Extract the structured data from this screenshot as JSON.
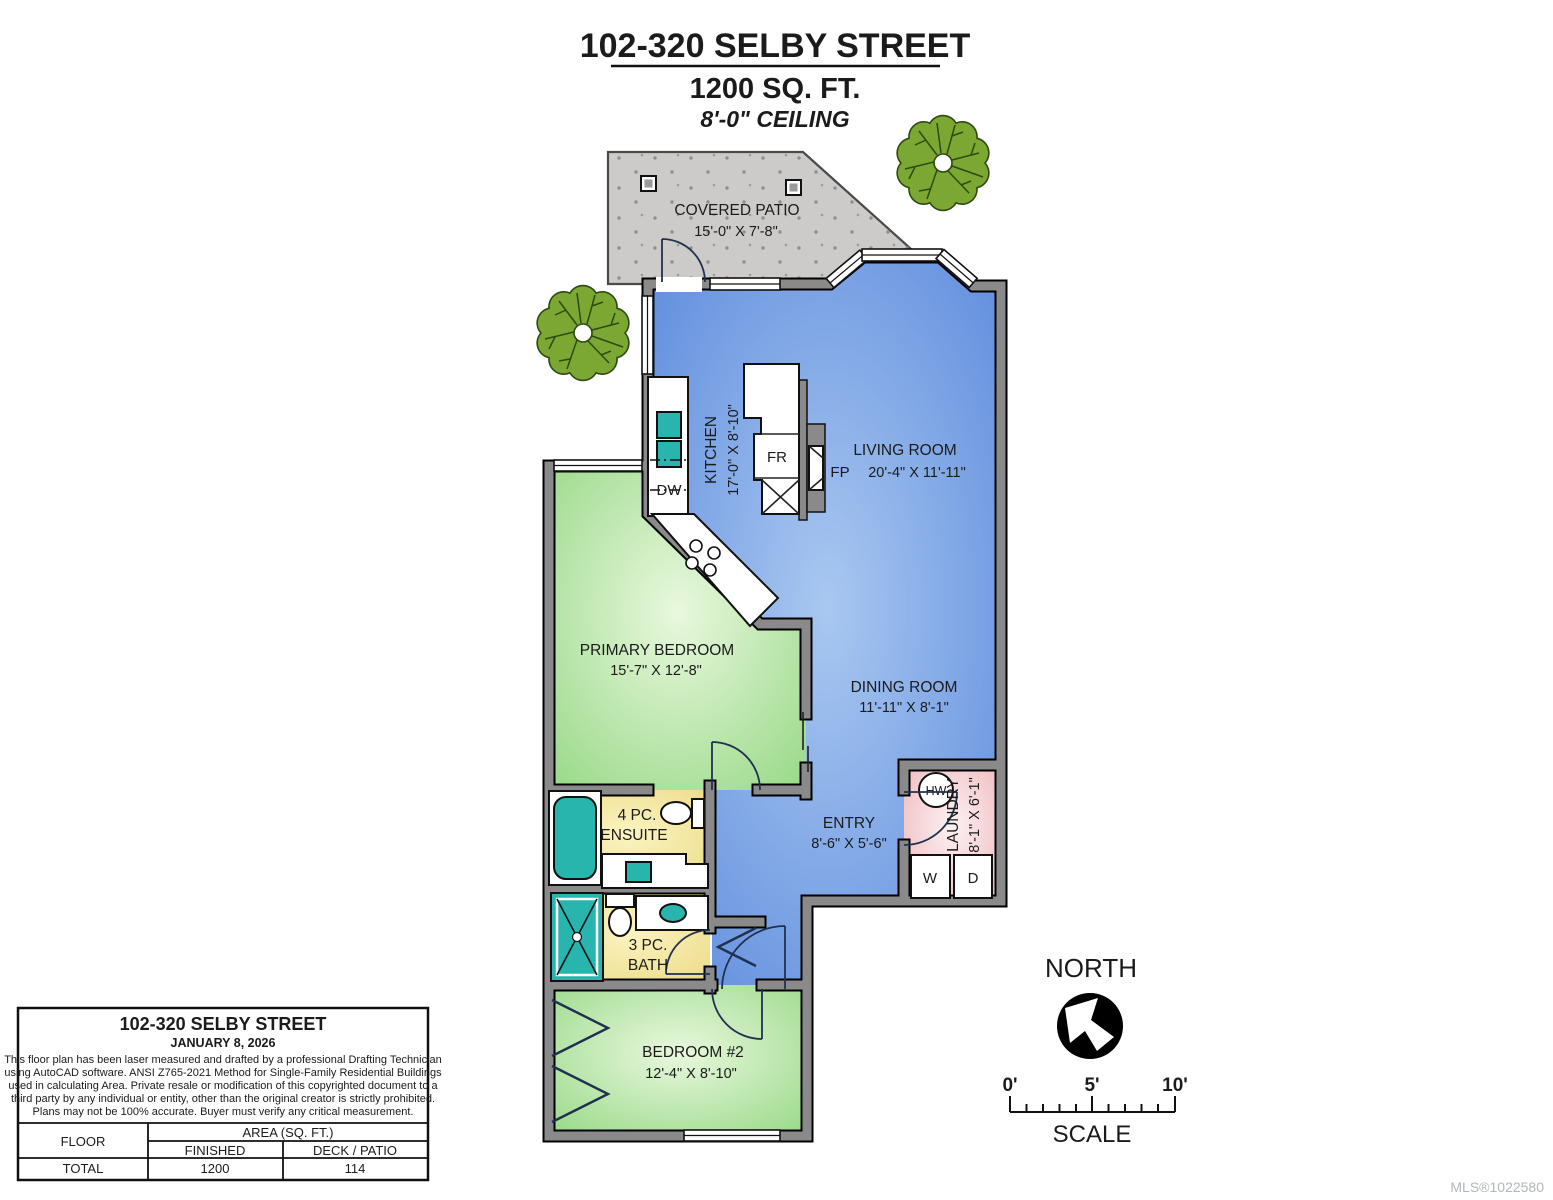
{
  "title": {
    "address": "102-320 SELBY STREET",
    "sqft": "1200 SQ. FT.",
    "ceiling": "8'-0\" CEILING"
  },
  "rooms": {
    "patio": {
      "name": "COVERED PATIO",
      "dims": "15'-0\" X 7'-8\""
    },
    "kitchen": {
      "name": "KITCHEN",
      "dims": "17'-0\" X 8'-10\""
    },
    "living": {
      "name": "LIVING ROOM",
      "dims": "20'-4\" X 11'-11\""
    },
    "dining": {
      "name": "DINING ROOM",
      "dims": "11'-11\" X 8'-1\""
    },
    "primary": {
      "name": "PRIMARY BEDROOM",
      "dims": "15'-7\" X 12'-8\""
    },
    "ensuite": {
      "line1": "4 PC.",
      "line2": "ENSUITE"
    },
    "bath": {
      "line1": "3 PC.",
      "line2": "BATH"
    },
    "entry": {
      "name": "ENTRY",
      "dims": "8'-6\" X 5'-6\""
    },
    "laundry": {
      "name": "LAUNDRY",
      "dims": "8'-1\" X 6'-1\""
    },
    "bedroom2": {
      "name": "BEDROOM #2",
      "dims": "12'-4\" X 8'-10\""
    }
  },
  "labels": {
    "fp": "FP",
    "fr": "FR",
    "dw": "DW",
    "hw": "HW",
    "w": "W",
    "d": "D"
  },
  "compass": {
    "north": "NORTH",
    "scale": "SCALE",
    "tick0": "0'",
    "tick5": "5'",
    "tick10": "10'"
  },
  "infobox": {
    "title": "102-320 SELBY STREET",
    "date": "JANUARY 8, 2026",
    "disclaimer": [
      "This floor plan has been laser measured and drafted by a professional Drafting Technician",
      "using AutoCAD software. ANSI Z765-2021 Method for Single-Family Residential Buildings",
      "used in calculating Area. Private resale or modification of this copyrighted document to a",
      "third party by any individual or entity, other than the original creator is strictly prohibited.",
      "Plans may not be 100% accurate.  Buyer must verify any critical measurement."
    ],
    "table": {
      "floor_header": "FLOOR",
      "area_header": "AREA (SQ. FT.)",
      "finished_header": "FINISHED",
      "deck_header": "DECK / PATIO",
      "total_label": "TOTAL",
      "finished_value": "1200",
      "deck_value": "114"
    }
  },
  "watermark": "MLS®1022580",
  "colors": {
    "wall": "#8a8a8a",
    "living_blue": "#5584da",
    "bedroom_green": "#8bd47a",
    "bath_yellow": "#e9d478",
    "laundry_pink": "#eba9ad",
    "fixture_teal": "#27b5ad",
    "patio_gray": "#cccbc9",
    "tree_green": "#7aa832"
  }
}
